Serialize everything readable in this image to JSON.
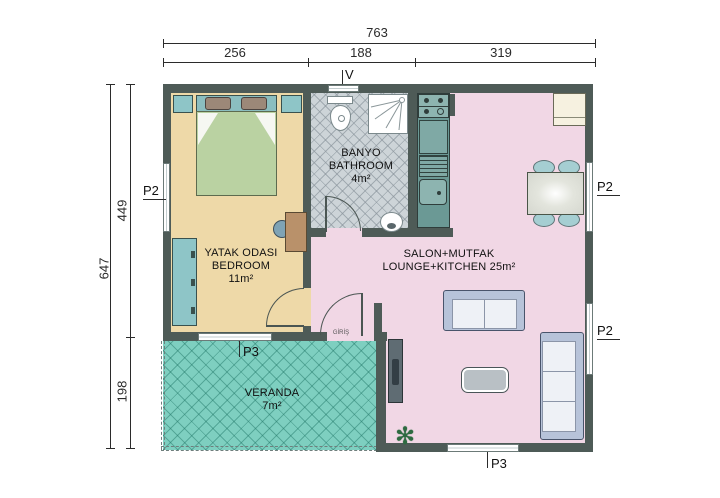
{
  "title": "prefab-house-floor-plan",
  "dimensions": {
    "top_total": "763",
    "top_segments": [
      "256",
      "188",
      "319"
    ],
    "left_total": "647",
    "left_segments": [
      "449",
      "198"
    ]
  },
  "rooms": {
    "bedroom": {
      "line1": "YATAK ODASI",
      "line2": "BEDROOM",
      "area": "11m²"
    },
    "bathroom": {
      "line1": "BANYO",
      "line2": "BATHROOM",
      "area": "4m²"
    },
    "lounge": {
      "line1": "SALON+MUTFAK",
      "line2": "LOUNGE+KITCHEN 25m²"
    },
    "veranda": {
      "line1": "VERANDA",
      "area": "7m²"
    }
  },
  "openings": {
    "p2_left": "P2",
    "p2_right_top": "P2",
    "p2_right_bottom": "P2",
    "p3_bedroom": "P3",
    "p3_lounge": "P3",
    "vent": "V",
    "entrance": "GİRİŞ"
  },
  "colors": {
    "wall": "#4e5b57",
    "bedroom_floor": "#eed9a8",
    "bathroom_floor": "#cdd4d8",
    "lounge_floor": "#f1d7e5",
    "veranda_floor": "#7ecfc0",
    "kitchen_counter": "#6b9995",
    "furniture_teal": "#8ec5c7",
    "bed_green": "#bad2a2",
    "sofa_frame": "#b7c3d9"
  }
}
